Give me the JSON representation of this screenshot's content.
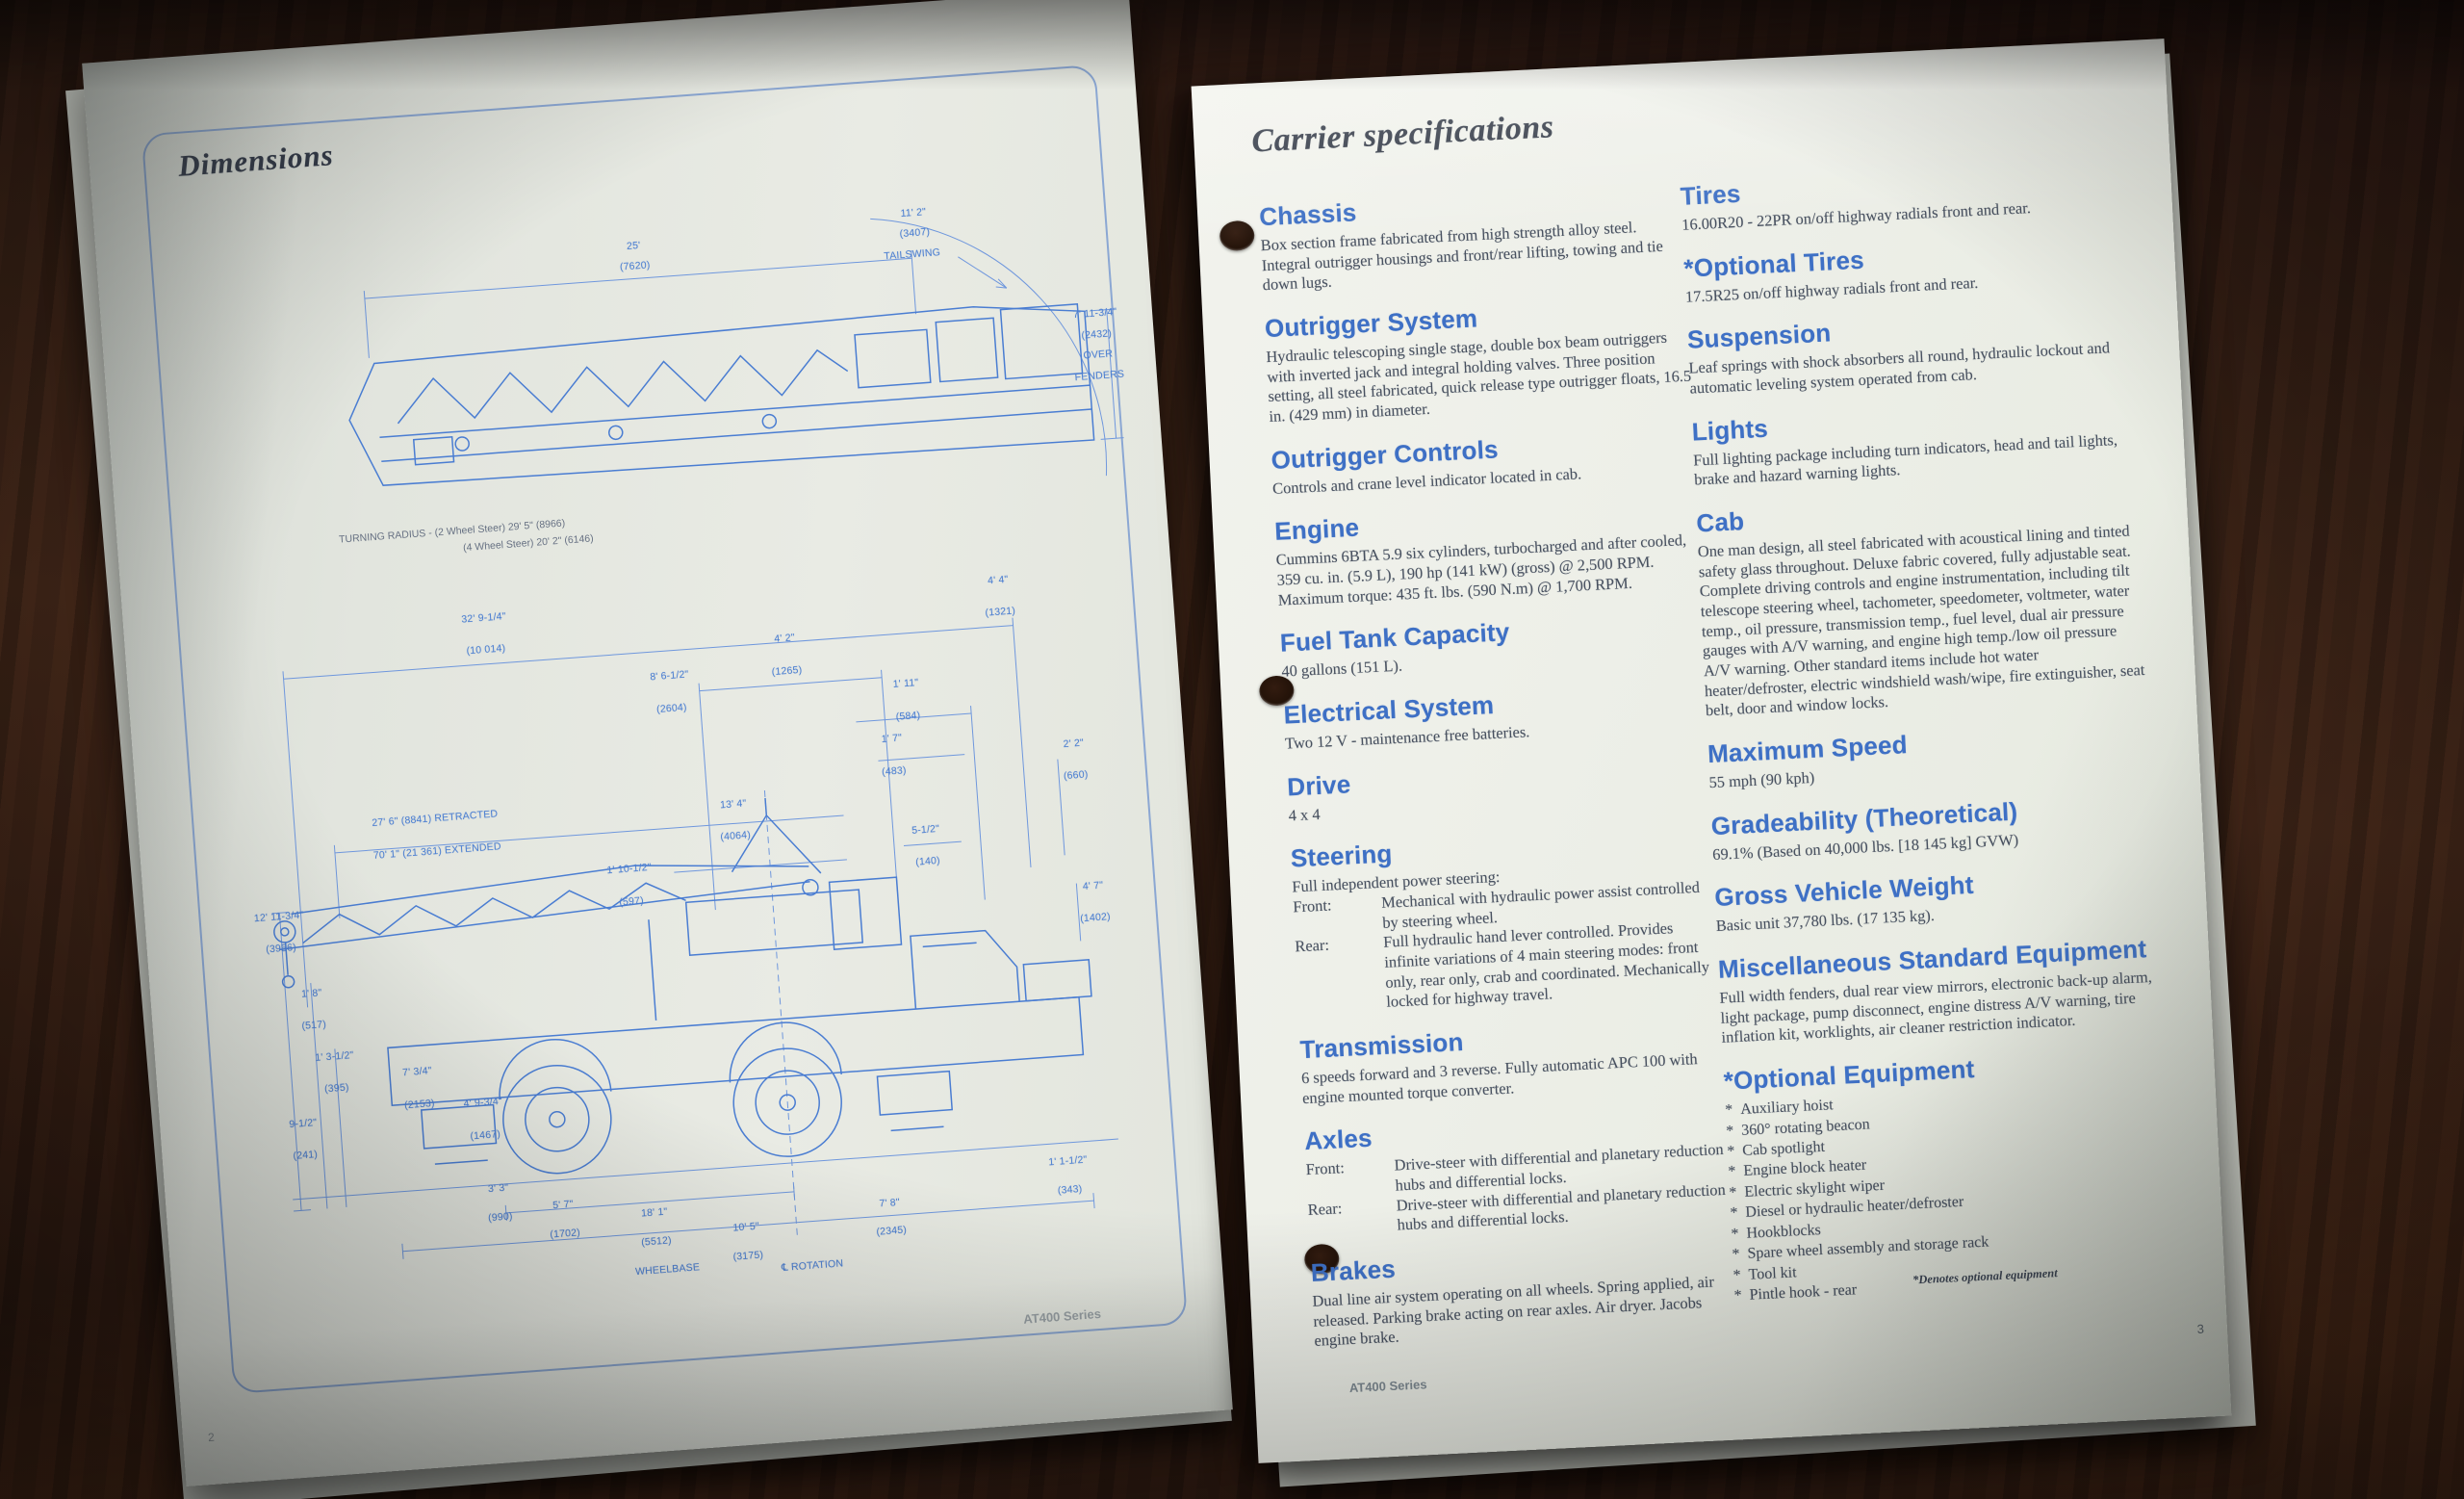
{
  "left_page": {
    "title": "Dimensions",
    "footer_brand": "AT400 Series",
    "page_number": "2",
    "turning_radius_lines": [
      "TURNING RADIUS - (2 Wheel Steer) 29' 5\" (8966)",
      "(4 Wheel Steer) 20' 2\" (6146)"
    ],
    "top_drawing_labels": [
      {
        "t": "25'",
        "x": 41,
        "y": 6
      },
      {
        "t": "(7620)",
        "x": 41,
        "y": 12.5
      },
      {
        "t": "11' 2\"",
        "x": 75,
        "y": 2
      },
      {
        "t": "(3407)",
        "x": 75,
        "y": 8.5
      },
      {
        "t": "TAILSWING",
        "x": 74.5,
        "y": 15
      },
      {
        "t": "7' 11-3/4\"",
        "x": 96,
        "y": 38
      },
      {
        "t": "(2432)",
        "x": 96,
        "y": 44.5
      },
      {
        "t": "OVER",
        "x": 96,
        "y": 51
      },
      {
        "t": "FENDERS",
        "x": 96,
        "y": 57.5
      }
    ],
    "bottom_drawing_labels": [
      {
        "t": "32' 9-1/4\"",
        "x": 30,
        "y": 4.5
      },
      {
        "t": "(10 014)",
        "x": 30,
        "y": 9
      },
      {
        "t": "4' 2\"",
        "x": 63,
        "y": 10.5
      },
      {
        "t": "(1265)",
        "x": 63,
        "y": 15
      },
      {
        "t": "4' 4\"",
        "x": 87,
        "y": 4.5
      },
      {
        "t": "(1321)",
        "x": 87,
        "y": 9
      },
      {
        "t": "8' 6-1/2\"",
        "x": 50,
        "y": 14.5
      },
      {
        "t": "(2604)",
        "x": 50,
        "y": 19
      },
      {
        "t": "1' 11\"",
        "x": 76,
        "y": 18
      },
      {
        "t": "(584)",
        "x": 76,
        "y": 22.5
      },
      {
        "t": "1' 7\"",
        "x": 74,
        "y": 25.5
      },
      {
        "t": "(483)",
        "x": 74,
        "y": 30
      },
      {
        "t": "27' 6\" (8841) RETRACTED",
        "x": 23,
        "y": 32
      },
      {
        "t": "70' 1\" (21 361) EXTENDED",
        "x": 23,
        "y": 36.5
      },
      {
        "t": "13' 4\"",
        "x": 56,
        "y": 33
      },
      {
        "t": "(4064)",
        "x": 56,
        "y": 37.5
      },
      {
        "t": "1' 10-1/2\"",
        "x": 44,
        "y": 41
      },
      {
        "t": "(597)",
        "x": 44,
        "y": 45.5
      },
      {
        "t": "5-1/2\"",
        "x": 77,
        "y": 38.5
      },
      {
        "t": "(140)",
        "x": 77,
        "y": 43
      },
      {
        "t": "2' 2\"",
        "x": 94,
        "y": 28
      },
      {
        "t": "(660)",
        "x": 94,
        "y": 32.5
      },
      {
        "t": "4' 7\"",
        "x": 95,
        "y": 48
      },
      {
        "t": "(1402)",
        "x": 95,
        "y": 52.5
      },
      {
        "t": "12' 11-3/4\"",
        "x": 5,
        "y": 44
      },
      {
        "t": "(3956)",
        "x": 5,
        "y": 48.5
      },
      {
        "t": "1' 8\"",
        "x": 8,
        "y": 55
      },
      {
        "t": "(517)",
        "x": 8,
        "y": 59.5
      },
      {
        "t": "1' 3-1/2\"",
        "x": 10,
        "y": 64
      },
      {
        "t": "(395)",
        "x": 10,
        "y": 68.5
      },
      {
        "t": "9-1/2\"",
        "x": 6,
        "y": 73
      },
      {
        "t": "(241)",
        "x": 6,
        "y": 77.5
      },
      {
        "t": "7' 3/4\"",
        "x": 19,
        "y": 67
      },
      {
        "t": "(2153)",
        "x": 19,
        "y": 71.5
      },
      {
        "t": "4' 9-3/4\"",
        "x": 26,
        "y": 72
      },
      {
        "t": "(1467)",
        "x": 26,
        "y": 76.5
      },
      {
        "t": "3' 3\"",
        "x": 27,
        "y": 84
      },
      {
        "t": "(990)",
        "x": 27,
        "y": 88
      },
      {
        "t": "5' 7\"",
        "x": 34,
        "y": 87
      },
      {
        "t": "(1702)",
        "x": 34,
        "y": 91
      },
      {
        "t": "18' 1\"",
        "x": 44,
        "y": 89
      },
      {
        "t": "(5512)",
        "x": 44,
        "y": 93
      },
      {
        "t": "WHEELBASE",
        "x": 45,
        "y": 97
      },
      {
        "t": "10' 5\"",
        "x": 54,
        "y": 92
      },
      {
        "t": "(3175)",
        "x": 54,
        "y": 96
      },
      {
        "t": "℄ ROTATION",
        "x": 61,
        "y": 98
      },
      {
        "t": "7' 8\"",
        "x": 70,
        "y": 90
      },
      {
        "t": "(2345)",
        "x": 70,
        "y": 94
      },
      {
        "t": "1' 1-1/2\"",
        "x": 90,
        "y": 86
      },
      {
        "t": "(343)",
        "x": 90,
        "y": 90
      }
    ]
  },
  "right_page": {
    "title": "Carrier specifications",
    "footer_brand": "AT400 Series",
    "page_number": "3",
    "footnote": "*Denotes optional equipment",
    "bullet_marker": "*",
    "columns": {
      "left": [
        {
          "title": "Chassis",
          "paragraphs": [
            "Box section frame fabricated from high strength alloy steel. Integral outrigger housings and front/rear lifting, towing and tie down lugs."
          ]
        },
        {
          "title": "Outrigger System",
          "paragraphs": [
            "Hydraulic telescoping single stage, double box beam outriggers with inverted jack and integral holding valves. Three position setting, all steel fabricated, quick release type outrigger floats, 16.5 in. (429 mm) in diameter."
          ]
        },
        {
          "title": "Outrigger Controls",
          "paragraphs": [
            "Controls and crane level indicator located in cab."
          ]
        },
        {
          "title": "Engine",
          "paragraphs": [
            "Cummins 6BTA 5.9 six cylinders, turbocharged and after cooled, 359 cu. in. (5.9 L), 190 hp (141 kW) (gross) @ 2,500 RPM.",
            "Maximum torque: 435 ft. lbs. (590 N.m) @ 1,700 RPM."
          ]
        },
        {
          "title": "Fuel Tank Capacity",
          "paragraphs": [
            "40 gallons (151 L)."
          ]
        },
        {
          "title": "Electrical System",
          "paragraphs": [
            "Two 12 V - maintenance free batteries."
          ]
        },
        {
          "title": "Drive",
          "paragraphs": [
            "4 x 4"
          ]
        },
        {
          "title": "Steering",
          "paragraphs": [
            "Full independent power steering:"
          ],
          "rows": [
            {
              "label": "Front:",
              "text": "Mechanical with hydraulic power assist controlled by steering wheel."
            },
            {
              "label": "Rear:",
              "text": "Full hydraulic hand lever controlled. Provides infinite variations of 4 main steering modes: front only, rear only, crab and coordinated. Mechanically locked for highway travel."
            }
          ]
        },
        {
          "title": "Transmission",
          "paragraphs": [
            "6 speeds forward and 3 reverse. Fully automatic APC 100 with engine mounted torque converter."
          ]
        },
        {
          "title": "Axles",
          "rows": [
            {
              "label": "Front:",
              "text": "Drive-steer with differential and planetary reduction hubs and differential locks."
            },
            {
              "label": "Rear:",
              "text": "Drive-steer with differential and planetary reduction hubs and differential locks."
            }
          ]
        },
        {
          "title": "Brakes",
          "paragraphs": [
            "Dual line air system operating on all wheels. Spring applied, air released. Parking brake acting on rear axles. Air dryer. Jacobs engine brake."
          ]
        }
      ],
      "right": [
        {
          "title": "Tires",
          "paragraphs": [
            "16.00R20 - 22PR on/off highway radials front and rear."
          ]
        },
        {
          "title": "*Optional Tires",
          "paragraphs": [
            "17.5R25 on/off highway radials front and rear."
          ]
        },
        {
          "title": "Suspension",
          "paragraphs": [
            "Leaf springs with shock absorbers all round, hydraulic lockout and automatic leveling system operated from cab."
          ]
        },
        {
          "title": "Lights",
          "paragraphs": [
            "Full lighting package including turn indicators, head and tail lights, brake and hazard warning lights."
          ]
        },
        {
          "title": "Cab",
          "paragraphs": [
            "One man design, all steel fabricated with acoustical lining and tinted safety glass throughout. Deluxe fabric covered, fully adjustable seat. Complete driving controls and engine instrumentation, including tilt telescope steering wheel, tachometer, speedometer, voltmeter, water temp., oil pressure, transmission temp., fuel level, dual air pressure gauges with A/V warning, and engine high temp./low oil pressure A/V warning. Other standard items include hot water heater/defroster, electric windshield wash/wipe, fire extinguisher, seat belt, door and window locks."
          ]
        },
        {
          "title": "Maximum Speed",
          "paragraphs": [
            "55 mph (90 kph)"
          ]
        },
        {
          "title": "Gradeability (Theoretical)",
          "paragraphs": [
            "69.1% (Based on 40,000 lbs. [18 145 kg] GVW)"
          ]
        },
        {
          "title": "Gross Vehicle Weight",
          "paragraphs": [
            "Basic unit 37,780 lbs. (17 135 kg)."
          ]
        },
        {
          "title": "Miscellaneous Standard Equipment",
          "paragraphs": [
            "Full width fenders, dual rear view mirrors, electronic back-up alarm, light package, pump disconnect, engine distress A/V warning, tire inflation kit, worklights, air cleaner restriction indicator."
          ]
        },
        {
          "title": "*Optional Equipment",
          "bullets": [
            "Auxiliary hoist",
            "360° rotating beacon",
            "Cab spotlight",
            "Engine block heater",
            "Electric skylight wiper",
            "Diesel or hydraulic heater/defroster",
            "Hookblocks",
            "Spare wheel assembly and storage rack",
            "Tool kit",
            "Pintle hook - rear"
          ]
        }
      ]
    }
  },
  "colors": {
    "heading_blue": "#3e70c5",
    "body_text": "#47505f",
    "drawing_blue": "#4a7dd2",
    "page_white": "#edefe8",
    "wood_brown": "#3a2115"
  }
}
